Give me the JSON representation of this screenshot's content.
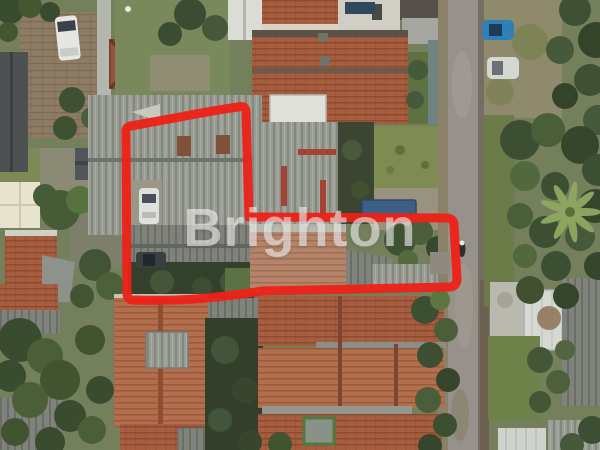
{
  "watermark": {
    "text": "Brighton"
  },
  "annotation": {
    "name": "property-boundary",
    "color": "#ee2117"
  },
  "palette": {
    "ground_green": "#74805c",
    "roof_gray": "#999d94",
    "roof_terracotta": "#a75d3f",
    "road_gray": "#96918a",
    "tree_green": "#3c4f32",
    "watermark_white": "#ffffff"
  }
}
